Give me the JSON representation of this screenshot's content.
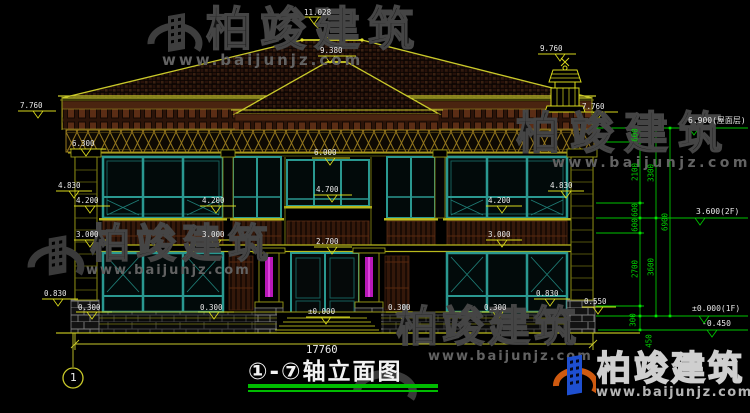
{
  "title": {
    "text": "①-⑦轴立面图",
    "axis_bubble": "1"
  },
  "watermark": {
    "brand": "柏竣建筑",
    "url": "www.baijunjz.com"
  },
  "elevations": {
    "main_ridge": "11.028",
    "porch_ridge": "9.380",
    "chimney_top": "9.760",
    "eave": "7.760",
    "cornice": "6.300",
    "balcony_top": "4.830",
    "center_win_head": "6.000",
    "center_win_sill": "4.700",
    "win_sill_2f": "4.200",
    "spandrel_base": "3.000",
    "door_head": "2.700",
    "pier_base_a": "0.830",
    "pier_base_b": "0.550",
    "win_sill_1f": "0.300",
    "ground_floor": "±0.000"
  },
  "dims": {
    "inner": [
      "600",
      "2100",
      "600",
      "600",
      "2700",
      "300",
      "450"
    ],
    "mid": [
      "3300",
      "3600"
    ],
    "overall_height": "6900",
    "overall_width": "17760"
  },
  "levels": {
    "roof": "6.900(屋面层)",
    "f2": "3.600(2F)",
    "f1": "±0.000(1F)",
    "grade": "-0.450"
  },
  "colors": {
    "cad_yellow": "#b9b91c",
    "marker_yellow": "#d8d81c",
    "dim_green": "#00c400",
    "window_teal": "#2a9890",
    "accent_magenta": "#b818b8",
    "tile_brown": "#26110a",
    "watermark_gray": "#454545",
    "title_green": "#00bb00"
  }
}
